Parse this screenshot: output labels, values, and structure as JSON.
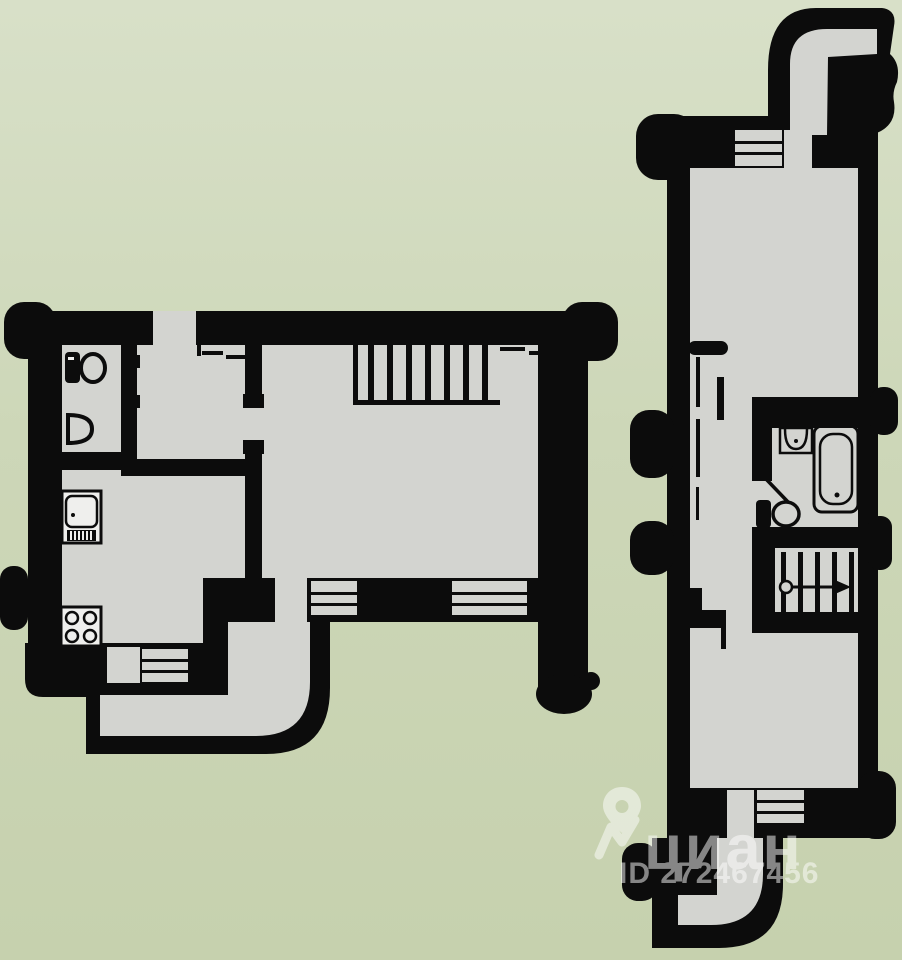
{
  "watermark": {
    "brand": "циан",
    "id_label": "ID 272467456",
    "pin_icon": "location-pin-icon",
    "logo_icon": "cian-zigzag-icon",
    "color": "#ffffff",
    "opacity": 0.5
  },
  "palette": {
    "background_top": "#d8e0c8",
    "background_bottom": "#c6d1ae",
    "wall": "#0c0c0c",
    "floor": "#d3d4d0",
    "fixture_fill": "#efefed"
  },
  "plans": {
    "left": {
      "name": "lower-level-floorplan",
      "fixtures": [
        "toilet-icon",
        "sink-icon",
        "fridge-icon",
        "stove-icon",
        "stairs",
        "window",
        "balcony"
      ]
    },
    "right": {
      "name": "upper-level-floorplan",
      "fixtures": [
        "sink-icon",
        "bathtub-icon",
        "toilet-icon",
        "stairs-with-arrow",
        "window",
        "balcony"
      ]
    }
  }
}
